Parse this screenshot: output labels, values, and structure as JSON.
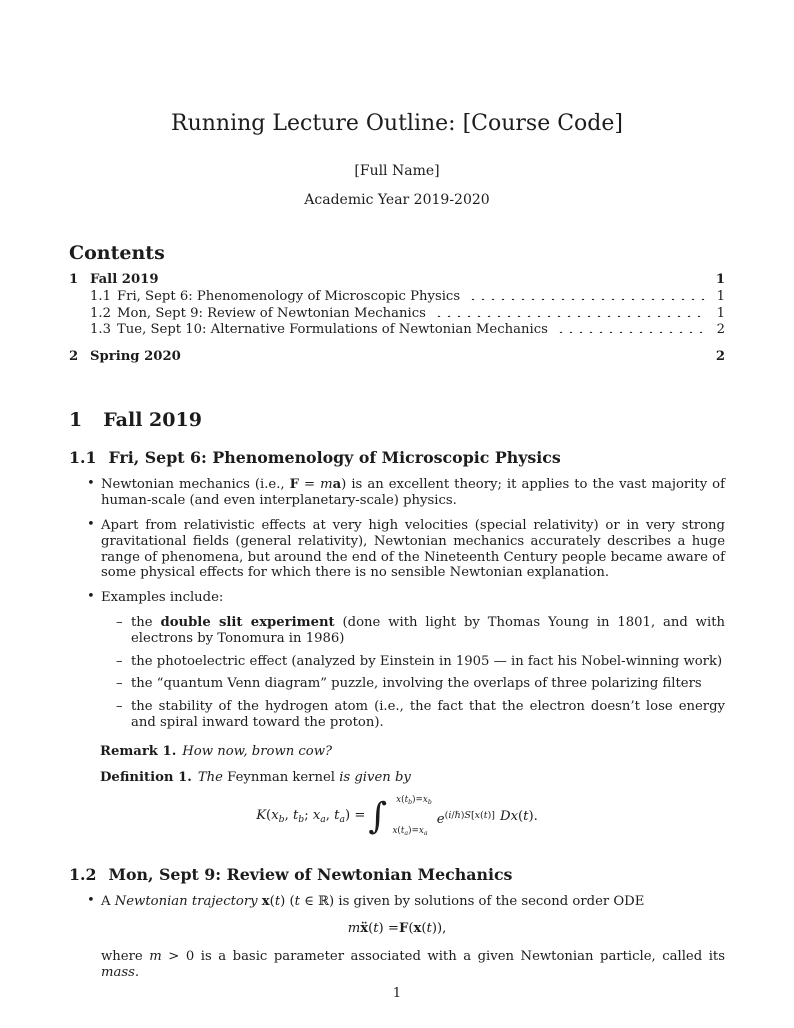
{
  "doc": {
    "title": "Running Lecture Outline: [Course Code]",
    "author": "[Full Name]",
    "date": "Academic Year 2019-2020",
    "page_number": "1"
  },
  "toc": {
    "heading": "Contents",
    "entries": [
      {
        "num": "1",
        "label": "Fall 2019",
        "page": "1"
      },
      {
        "num": "1.1",
        "label": "Fri, Sept 6: Phenomenology of Microscopic Physics",
        "page": "1"
      },
      {
        "num": "1.2",
        "label": "Mon, Sept 9: Review of Newtonian Mechanics",
        "page": "1"
      },
      {
        "num": "1.3",
        "label": "Tue, Sept 10: Alternative Formulations of Newtonian Mechanics",
        "page": "2"
      },
      {
        "num": "2",
        "label": "Spring 2020",
        "page": "2"
      }
    ]
  },
  "body": {
    "section1": {
      "num": "1",
      "title": "Fall 2019"
    },
    "sub11": {
      "num": "1.1",
      "title": "Fri, Sept 6: Phenomenology of Microscopic Physics"
    },
    "bullets11": {
      "b1": [
        {
          "t": "Newtonian mechanics (i.e., "
        },
        {
          "t": "F",
          "s": "b"
        },
        {
          "t": " = "
        },
        {
          "t": "m",
          "s": "i"
        },
        {
          "t": "a",
          "s": "b"
        },
        {
          "t": ") is an excellent theory; it applies to the vast majority of human-scale (and even interplanetary-scale) physics."
        }
      ],
      "b2": [
        {
          "t": "Apart from relativistic effects at very high velocities (special relativity) or in very strong gravitational fields (general relativity), Newtonian mechanics accurately describes a huge range of phenomena, but around the end of the Nineteenth Century people became aware of some physical effects for which there is no sensible Newtonian explanation."
        }
      ],
      "b3": [
        {
          "t": "Examples include:"
        }
      ],
      "examples": {
        "a": [
          {
            "t": "the "
          },
          {
            "t": "double slit experiment",
            "s": "b"
          },
          {
            "t": " (done with light by Thomas Young in 1801, and with electrons by Tonomura in 1986)"
          }
        ],
        "b": [
          {
            "t": "the photoelectric effect (analyzed by Einstein in 1905 — in fact his Nobel-winning work)"
          }
        ],
        "c": [
          {
            "t": "the “quantum Venn diagram” puzzle, involving the overlaps of three polarizing filters"
          }
        ],
        "d": [
          {
            "t": "the stability of the hydrogen atom (i.e., the fact that the electron doesn’t lose energy and spiral inward toward the proton)."
          }
        ]
      }
    },
    "remark": {
      "label": "Remark 1.",
      "body": [
        {
          "t": "How now, brown cow?",
          "s": "i"
        }
      ]
    },
    "definition": {
      "label": "Definition 1.",
      "body": [
        {
          "t": "The ",
          "s": "i"
        },
        {
          "t": "Feynman kernel"
        },
        {
          "t": " is given by",
          "s": "i"
        }
      ]
    },
    "feynman": {
      "int_sign": "∫",
      "lhs": [
        {
          "t": "K",
          "s": "i"
        },
        {
          "t": "("
        },
        {
          "t": "x",
          "s": "i"
        },
        {
          "t": "b",
          "s": "i sub"
        },
        {
          "t": ", "
        },
        {
          "t": "t",
          "s": "i"
        },
        {
          "t": "b",
          "s": "i sub"
        },
        {
          "t": "; "
        },
        {
          "t": "x",
          "s": "i"
        },
        {
          "t": "a",
          "s": "i sub"
        },
        {
          "t": ", "
        },
        {
          "t": "t",
          "s": "i"
        },
        {
          "t": "a",
          "s": "i sub"
        },
        {
          "t": ") = "
        }
      ],
      "upper": [
        {
          "t": "x",
          "s": "i"
        },
        {
          "t": "("
        },
        {
          "t": "t",
          "s": "i"
        },
        {
          "t": "b",
          "s": "i sub"
        },
        {
          "t": ")="
        },
        {
          "t": "x",
          "s": "i"
        },
        {
          "t": "b",
          "s": "i sub"
        }
      ],
      "lower": [
        {
          "t": "x",
          "s": "i"
        },
        {
          "t": "("
        },
        {
          "t": "t",
          "s": "i"
        },
        {
          "t": "a",
          "s": "i sub"
        },
        {
          "t": ")="
        },
        {
          "t": "x",
          "s": "i"
        },
        {
          "t": "a",
          "s": "i sub"
        }
      ],
      "base": [
        {
          "t": "e",
          "s": "i"
        }
      ],
      "exp": [
        {
          "t": "("
        },
        {
          "t": "i",
          "s": "i"
        },
        {
          "t": "/"
        },
        {
          "t": "ℏ",
          "s": "i"
        },
        {
          "t": ")"
        },
        {
          "t": "S",
          "s": "i"
        },
        {
          "t": "["
        },
        {
          "t": "x",
          "s": "i"
        },
        {
          "t": "("
        },
        {
          "t": "t",
          "s": "i"
        },
        {
          "t": ")]"
        }
      ],
      "measure": [
        {
          "t": "D",
          "s": "i"
        },
        {
          "t": "x",
          "s": "i"
        },
        {
          "t": "("
        },
        {
          "t": "t",
          "s": "i"
        },
        {
          "t": ")."
        }
      ]
    },
    "sub12": {
      "num": "1.2",
      "title": "Mon, Sept 9: Review of Newtonian Mechanics"
    },
    "bullets12": {
      "b1": [
        {
          "t": "A "
        },
        {
          "t": "Newtonian trajectory ",
          "s": "i"
        },
        {
          "t": "x",
          "s": "b"
        },
        {
          "t": "("
        },
        {
          "t": "t",
          "s": "i"
        },
        {
          "t": ") ("
        },
        {
          "t": "t",
          "s": "i"
        },
        {
          "t": " ∈ ℝ) is given by solutions of the second order ODE"
        }
      ],
      "eq": [
        {
          "t": "m",
          "s": "i"
        },
        {
          "t": " "
        },
        {
          "t": "ẍ",
          "s": "b"
        },
        {
          "t": "("
        },
        {
          "t": "t",
          "s": "i"
        },
        {
          "t": ") = "
        },
        {
          "t": "F",
          "s": "b"
        },
        {
          "t": "("
        },
        {
          "t": "x",
          "s": "b"
        },
        {
          "t": "("
        },
        {
          "t": "t",
          "s": "i"
        },
        {
          "t": ")),"
        }
      ],
      "cont": [
        {
          "t": "where "
        },
        {
          "t": "m",
          "s": "i"
        },
        {
          "t": " > 0 is a basic parameter associated with a given Newtonian particle, called its "
        },
        {
          "t": "mass",
          "s": "i"
        },
        {
          "t": "."
        }
      ]
    }
  }
}
